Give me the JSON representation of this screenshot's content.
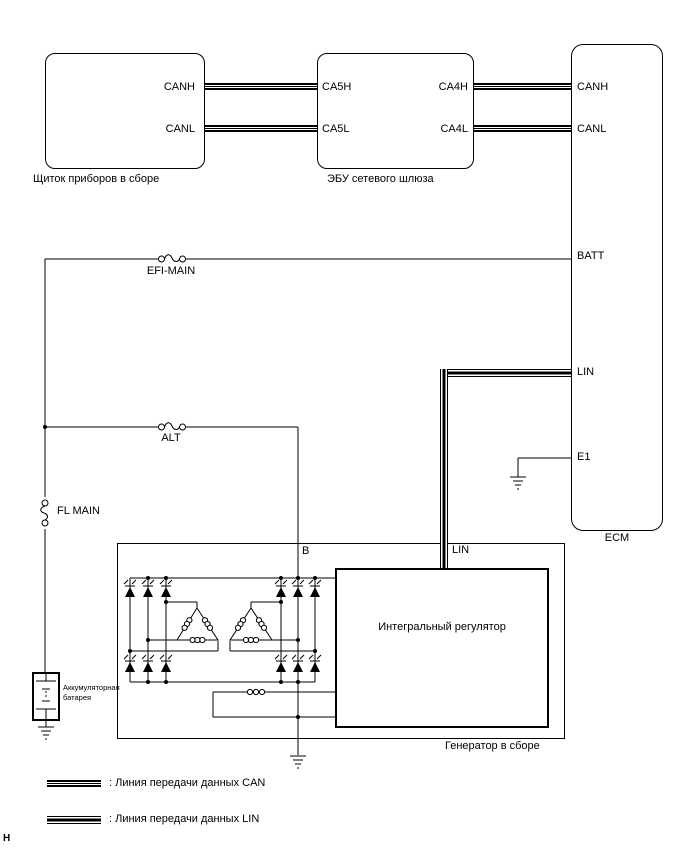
{
  "page": {
    "corner_mark": "H"
  },
  "colors": {
    "line": "#000000",
    "background": "#ffffff"
  },
  "components": {
    "instrument_panel": {
      "label": "Щиток приборов в сборе",
      "pin_canh": "CANH",
      "pin_canl": "CANL"
    },
    "gateway_ecu": {
      "label": "ЭБУ сетевого шлюза",
      "pin_ca5h": "CA5H",
      "pin_ca5l": "CA5L",
      "pin_ca4h": "CA4H",
      "pin_ca4l": "CA4L"
    },
    "ecm": {
      "label": "ECM",
      "pin_canh": "CANH",
      "pin_canl": "CANL",
      "pin_batt": "BATT",
      "pin_lin": "LIN",
      "pin_e1": "E1"
    },
    "generator": {
      "label": "Генератор в сборе",
      "pin_b": "B",
      "pin_lin": "LIN",
      "regulator_label": "Интегральный регулятор"
    },
    "battery": {
      "label_line1": "Аккумуляторная",
      "label_line2": "батарея"
    }
  },
  "fuses": {
    "efi_main": "EFI-MAIN",
    "alt": "ALT",
    "fl_main": "FL MAIN"
  },
  "legend": {
    "can_label": ": Линия передачи данных CAN",
    "lin_label": ": Линия передачи данных LIN"
  }
}
